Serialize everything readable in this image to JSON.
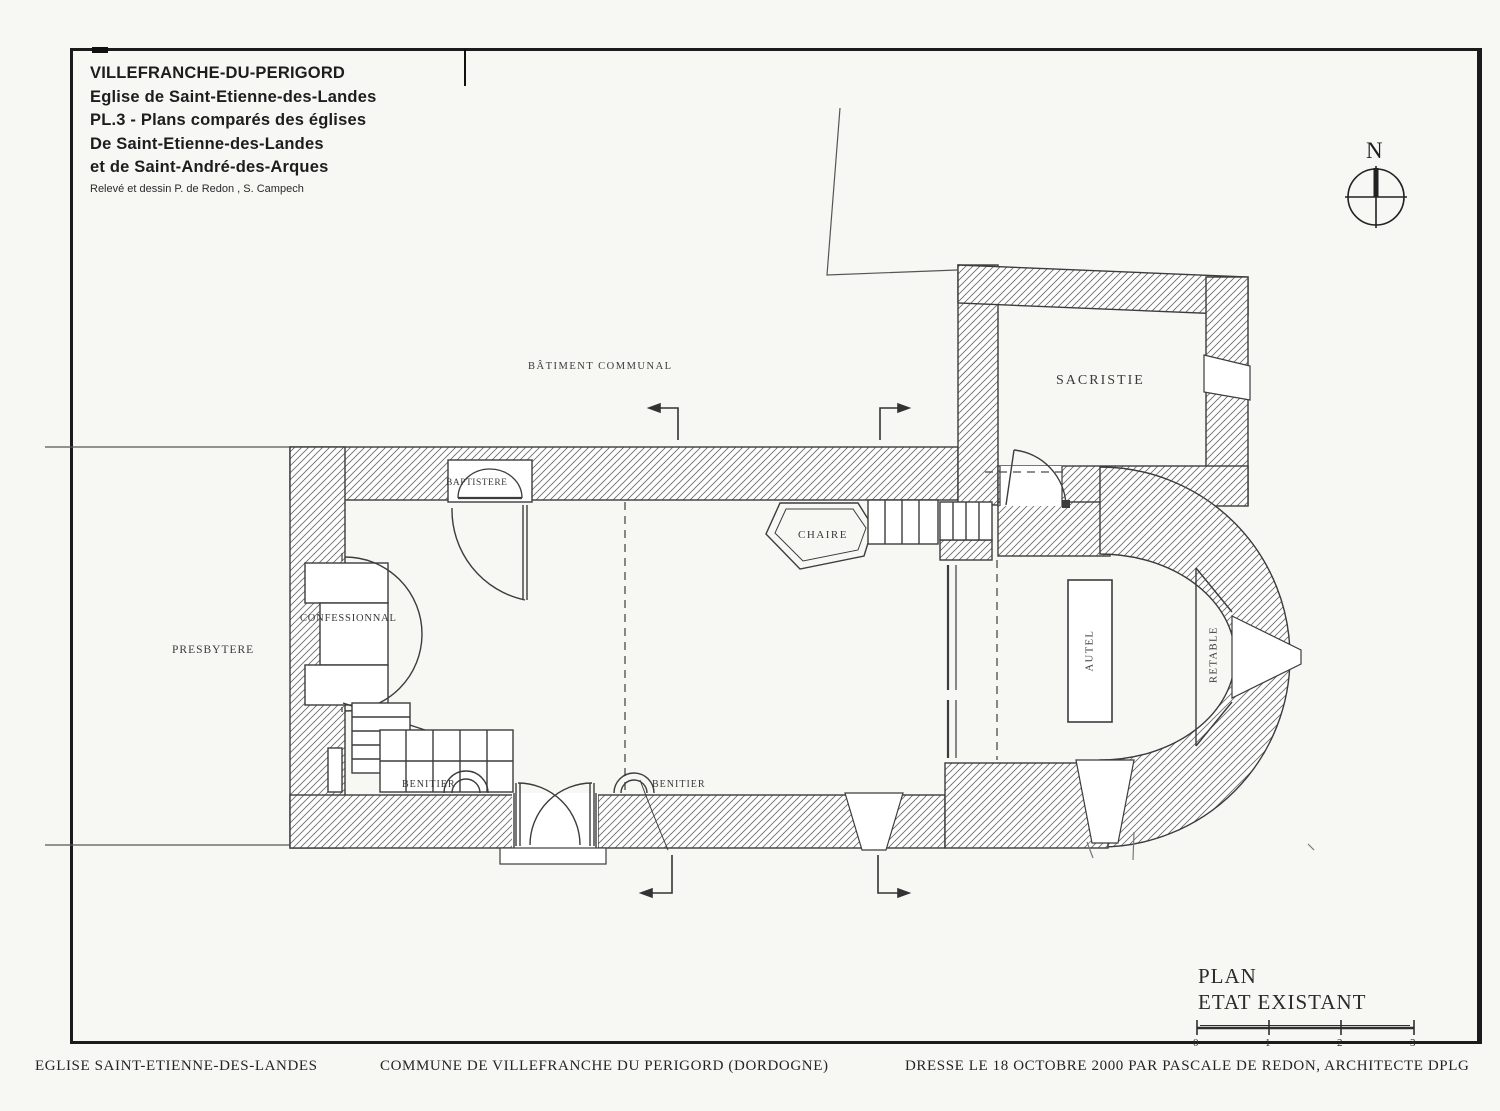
{
  "title_block": {
    "line1": "VILLEFRANCHE-DU-PERIGORD",
    "line2": "Eglise de Saint-Etienne-des-Landes",
    "line3": "PL.3 - Plans comparés des églises",
    "line4": "De Saint-Etienne-des-Landes",
    "line5": "et de Saint-André-des-Arques",
    "credit": "Relevé et dessin P. de Redon , S. Campech"
  },
  "north_arrow": {
    "label": "N"
  },
  "plan_labels": {
    "batiment_communal": "BÂTIMENT COMMUNAL",
    "sacristie": "SACRISTIE",
    "baptistere": "BAPTISTERE",
    "chaire": "CHAIRE",
    "confessionnal": "CONFESSIONNAL",
    "presbytere": "PRESBYTERE",
    "benitier_ouest": "BENITIER",
    "benitier_est": "BENITIER",
    "autel": "AUTEL",
    "retable": "RETABLE"
  },
  "legend": {
    "title_line1": "PLAN",
    "title_line2": "ETAT EXISTANT",
    "scale_ticks": [
      "0",
      "1",
      "2",
      "3"
    ]
  },
  "footer": {
    "left": "EGLISE SAINT-ETIENNE-DES-LANDES",
    "center": "COMMUNE DE VILLEFRANCHE DU PERIGORD (DORDOGNE)",
    "right": "DRESSE LE 18 OCTOBRE 2000 PAR PASCALE DE REDON, ARCHITECTE DPLG"
  },
  "colors": {
    "ink": "#2f2f2f",
    "hatch": "#6e6e6e",
    "paper": "#f7f7f4"
  }
}
